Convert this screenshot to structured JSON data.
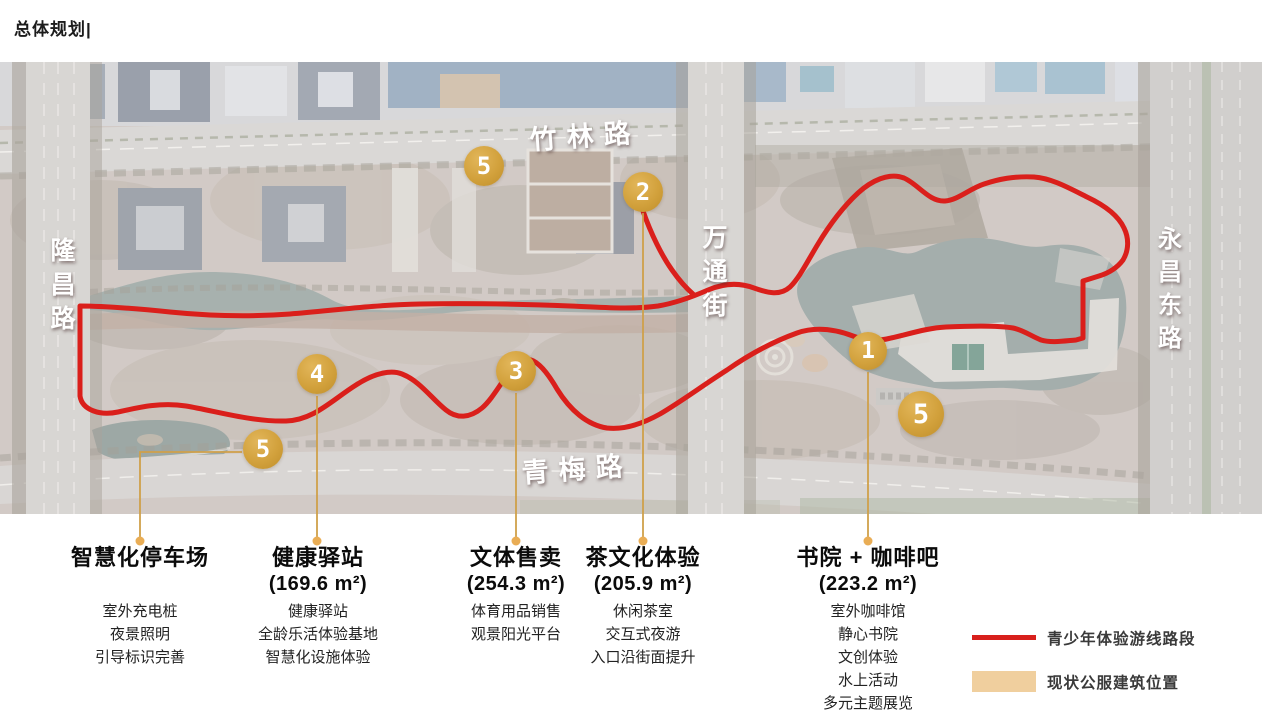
{
  "page": {
    "title": "总体规划|"
  },
  "map": {
    "roads": [
      {
        "name": "zhulin-road",
        "label": "竹林路"
      },
      {
        "name": "wantong-street",
        "label": "万通街"
      },
      {
        "name": "longchang-road",
        "label": "隆昌路"
      },
      {
        "name": "yongchang-east-road",
        "label": "永昌东路"
      },
      {
        "name": "qingmei-road",
        "label": "青梅路"
      }
    ],
    "markers": [
      {
        "number": "5"
      },
      {
        "number": "2"
      },
      {
        "number": "4"
      },
      {
        "number": "3"
      },
      {
        "number": "1"
      },
      {
        "number": "5"
      },
      {
        "number": "5"
      }
    ]
  },
  "callouts": [
    {
      "title": "智慧化停车场",
      "area": "",
      "items": [
        "室外充电桩",
        "夜景照明",
        "引导标识完善"
      ]
    },
    {
      "title": "健康驿站",
      "area": "(169.6 m²)",
      "items": [
        "健康驿站",
        "全龄乐活体验基地",
        "智慧化设施体验"
      ]
    },
    {
      "title": "文体售卖",
      "area": "(254.3 m²)",
      "items": [
        "体育用品销售",
        "观景阳光平台"
      ]
    },
    {
      "title": "茶文化体验",
      "area": "(205.9 m²)",
      "items": [
        "休闲茶室",
        "交互式夜游",
        "入口沿街面提升"
      ]
    },
    {
      "title": "书院 + 咖啡吧",
      "area": "(223.2 m²)",
      "items": [
        "室外咖啡馆",
        "静心书院",
        "文创体验",
        "水上活动",
        "多元主题展览"
      ]
    }
  ],
  "legend": {
    "items": [
      {
        "label": "青少年体验游线路段",
        "swatch_type": "line",
        "swatch_color": "#d8201c"
      },
      {
        "label": "现状公服建筑位置",
        "swatch_type": "rect",
        "swatch_color": "#f0cf9e"
      }
    ]
  },
  "colors": {
    "route_red": "#da1f1b",
    "marker_gold": "#d2a13c",
    "leader_gold": "#cfa04a",
    "legend_tan": "#f0cf9e"
  }
}
